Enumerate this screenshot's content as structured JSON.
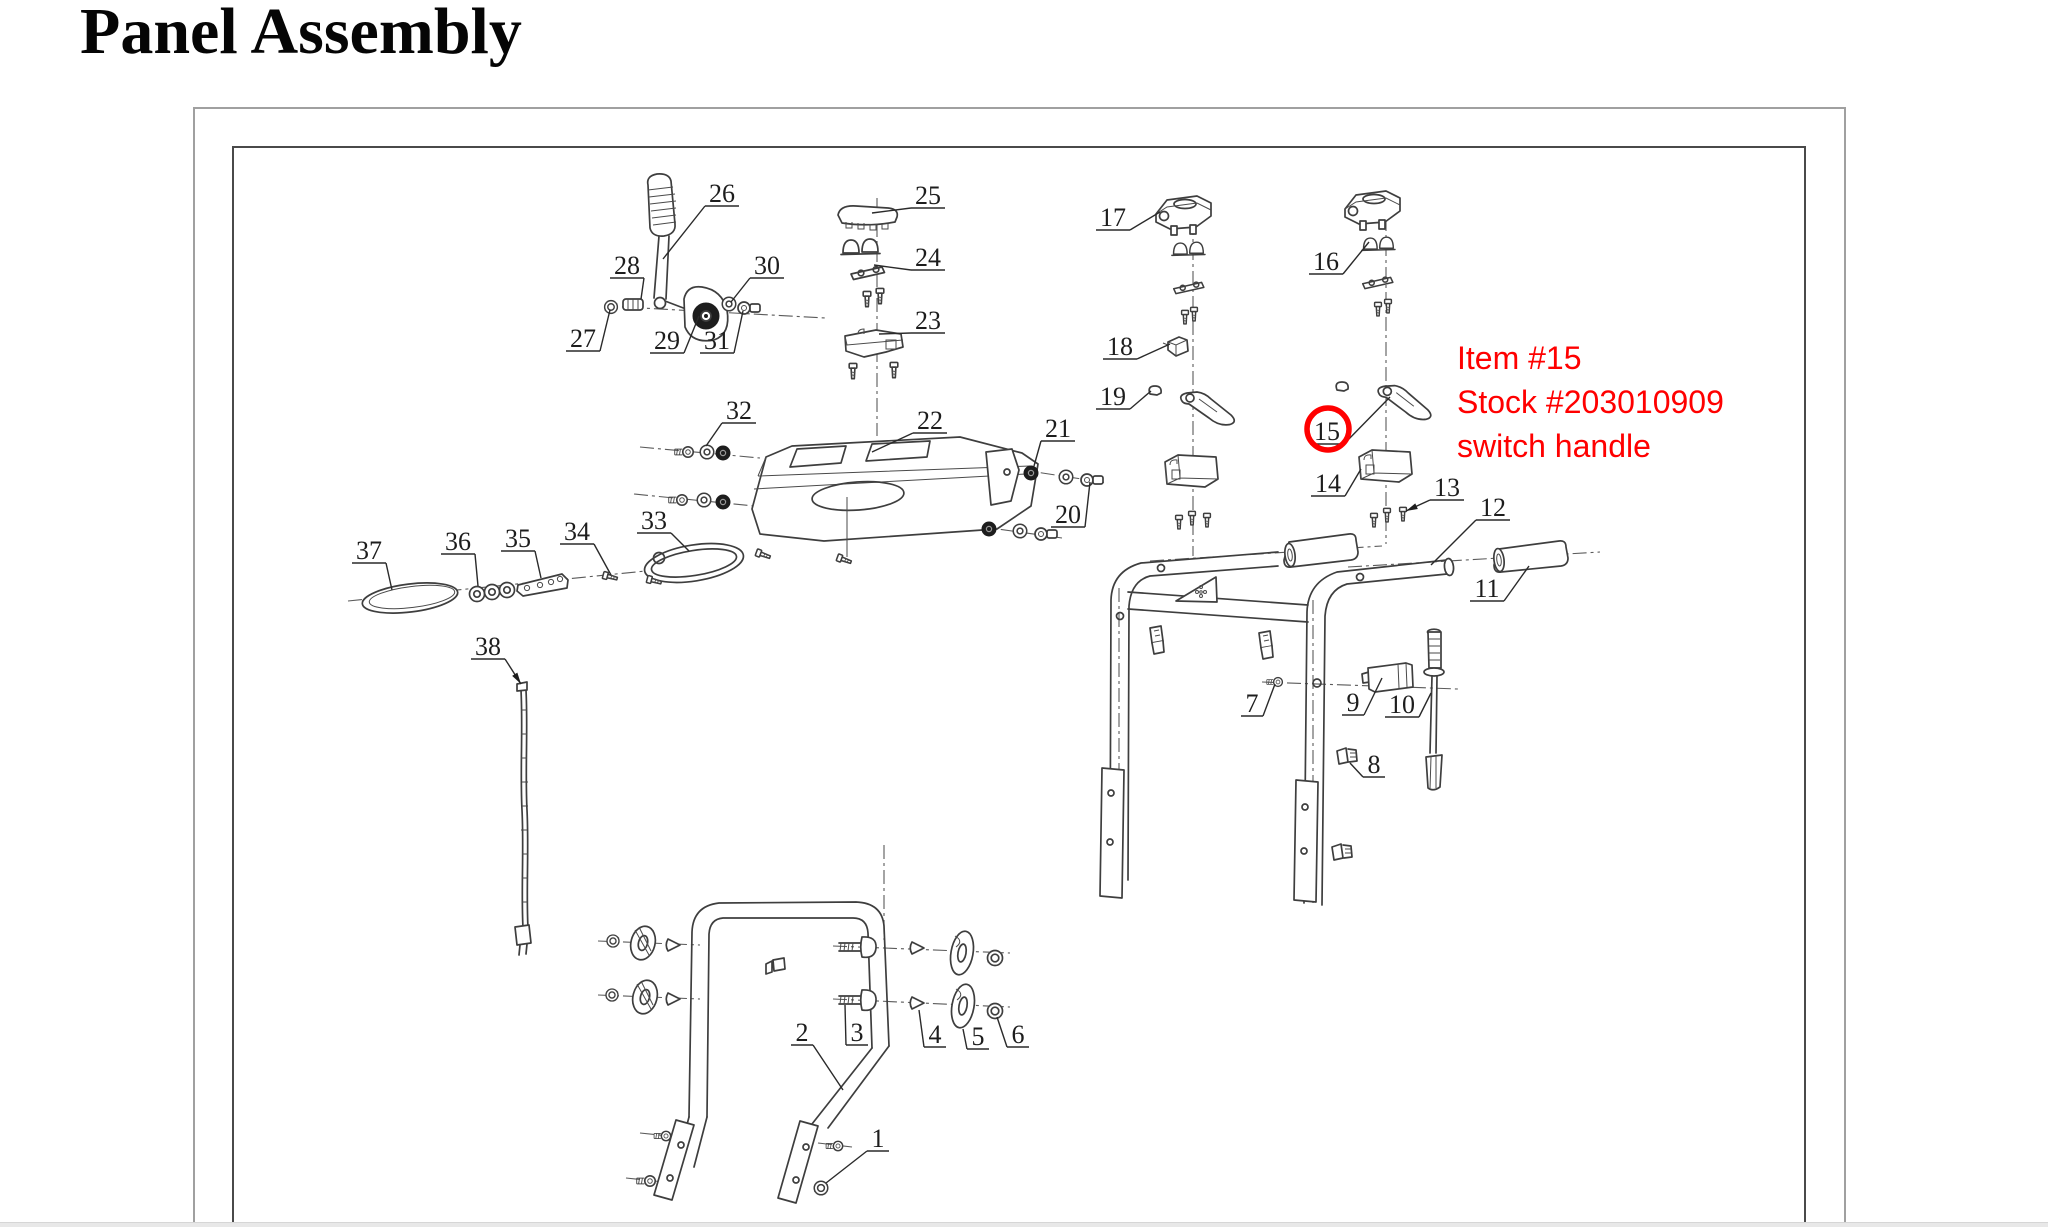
{
  "page": {
    "title": "Panel Assembly"
  },
  "annotation": {
    "color": "#ff0000",
    "lines": [
      "Item #15",
      "Stock #203010909",
      "switch handle"
    ],
    "highlight": {
      "part": "15",
      "cx": 1328,
      "cy": 429,
      "r": 21,
      "stroke_width": 5.5
    }
  },
  "footer": {
    "bar_color": "#e8e8e8"
  },
  "diagram": {
    "line_color": "#3e3e3e",
    "label_color": "#1d1d1d",
    "labels": [
      {
        "n": "1",
        "x": 878,
        "y": 1138,
        "tx": 826,
        "ty": 1183
      },
      {
        "n": "2",
        "x": 802,
        "y": 1032,
        "tx": 843,
        "ty": 1090
      },
      {
        "n": "3",
        "x": 857,
        "y": 1032,
        "tx": 845,
        "ty": 1005
      },
      {
        "n": "4",
        "x": 935,
        "y": 1034,
        "tx": 919,
        "ty": 1010
      },
      {
        "n": "5",
        "x": 978,
        "y": 1036,
        "tx": 963,
        "ty": 1029
      },
      {
        "n": "6",
        "x": 1018,
        "y": 1034,
        "tx": 997,
        "ty": 1017
      },
      {
        "n": "7",
        "x": 1252,
        "y": 703,
        "tx": 1275,
        "ty": 684
      },
      {
        "n": "8",
        "x": 1374,
        "y": 764,
        "tx": 1350,
        "ty": 763
      },
      {
        "n": "9",
        "x": 1353,
        "y": 702,
        "tx": 1382,
        "ty": 678
      },
      {
        "n": "10",
        "x": 1402,
        "y": 704,
        "tx": 1431,
        "ty": 693
      },
      {
        "n": "11",
        "x": 1487,
        "y": 588,
        "tx": 1529,
        "ty": 566
      },
      {
        "n": "12",
        "x": 1493,
        "y": 507,
        "tx": 1431,
        "ty": 565
      },
      {
        "n": "13",
        "x": 1447,
        "y": 487,
        "tx": 1406,
        "ty": 511,
        "arrow": true
      },
      {
        "n": "14",
        "x": 1328,
        "y": 483,
        "tx": 1361,
        "ty": 469
      },
      {
        "n": "15",
        "x": 1327,
        "y": 431,
        "tx": 1390,
        "ty": 397
      },
      {
        "n": "16",
        "x": 1326,
        "y": 261,
        "tx": 1369,
        "ty": 242
      },
      {
        "n": "17",
        "x": 1113,
        "y": 217,
        "tx": 1160,
        "ty": 212
      },
      {
        "n": "18",
        "x": 1120,
        "y": 346,
        "tx": 1170,
        "ty": 344
      },
      {
        "n": "19",
        "x": 1113,
        "y": 396,
        "tx": 1151,
        "ty": 391
      },
      {
        "n": "20",
        "x": 1068,
        "y": 514,
        "tx": 1090,
        "ty": 482
      },
      {
        "n": "21",
        "x": 1058,
        "y": 428,
        "tx": 1034,
        "ty": 466
      },
      {
        "n": "22",
        "x": 930,
        "y": 420,
        "tx": 872,
        "ty": 452
      },
      {
        "n": "23",
        "x": 928,
        "y": 320,
        "tx": 879,
        "ty": 334
      },
      {
        "n": "24",
        "x": 928,
        "y": 257,
        "tx": 874,
        "ty": 265
      },
      {
        "n": "25",
        "x": 928,
        "y": 195,
        "tx": 872,
        "ty": 213
      },
      {
        "n": "26",
        "x": 722,
        "y": 193,
        "tx": 663,
        "ty": 259
      },
      {
        "n": "27",
        "x": 583,
        "y": 338,
        "tx": 610,
        "ty": 310
      },
      {
        "n": "28",
        "x": 627,
        "y": 265,
        "tx": 641,
        "ty": 299
      },
      {
        "n": "29",
        "x": 667,
        "y": 340,
        "tx": 699,
        "ty": 316
      },
      {
        "n": "30",
        "x": 767,
        "y": 265,
        "tx": 731,
        "ty": 302
      },
      {
        "n": "31",
        "x": 717,
        "y": 340,
        "tx": 743,
        "ty": 311
      },
      {
        "n": "32",
        "x": 739,
        "y": 410,
        "tx": 706,
        "ty": 446
      },
      {
        "n": "33",
        "x": 654,
        "y": 520,
        "tx": 689,
        "ty": 551
      },
      {
        "n": "34",
        "x": 577,
        "y": 531,
        "tx": 611,
        "ty": 575
      },
      {
        "n": "35",
        "x": 518,
        "y": 538,
        "tx": 541,
        "ty": 578
      },
      {
        "n": "36",
        "x": 458,
        "y": 541,
        "tx": 478,
        "ty": 586
      },
      {
        "n": "37",
        "x": 369,
        "y": 550,
        "tx": 392,
        "ty": 590
      },
      {
        "n": "38",
        "x": 488,
        "y": 646,
        "tx": 521,
        "ty": 684,
        "arrow": true
      }
    ]
  }
}
